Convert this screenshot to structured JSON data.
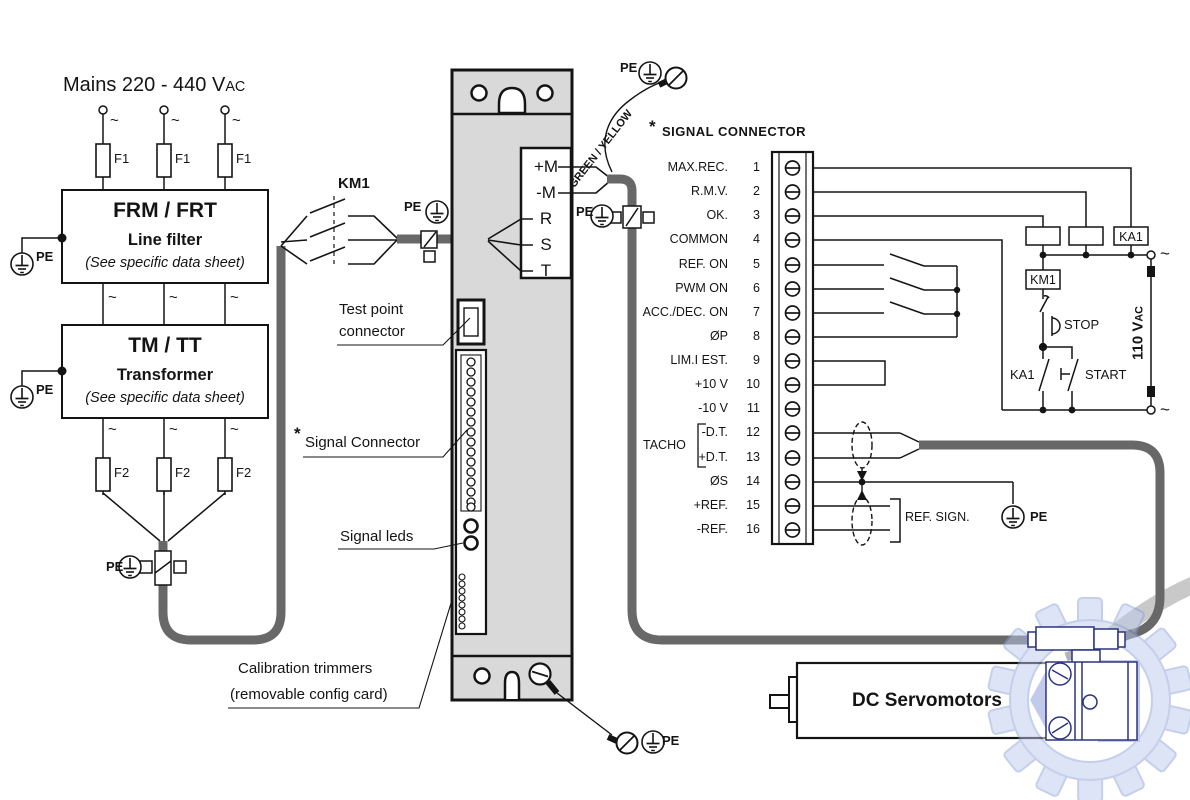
{
  "shared": {
    "pe": "PE",
    "tilde": "~"
  },
  "mains": {
    "title_main": "Mains 220 - 440 V",
    "title_ac": "AC",
    "fuse1": "F1",
    "fuse2": "F2"
  },
  "line_filter": {
    "title": "FRM / FRT",
    "subtitle": "Line filter",
    "note": "(See specific data sheet)"
  },
  "transformer": {
    "title": "TM / TT",
    "subtitle": "Transformer",
    "note": "(See specific data sheet)"
  },
  "contactor_label": "KM1",
  "drive": {
    "terminals": [
      "+M",
      "-M",
      "R",
      "S",
      "T"
    ],
    "test_point_line1": "Test point",
    "test_point_line2": "connector",
    "asterisk": "*",
    "signal_connector_label": "Signal Connector",
    "signal_leds_label": "Signal leds",
    "calibration_line1": "Calibration trimmers",
    "calibration_line2": "(removable config card)"
  },
  "ground_wire_label": "GREEN / YELLOW",
  "signal_connector": {
    "asterisk": "*",
    "title": "SIGNAL  CONNECTOR",
    "tacho_label": "TACHO",
    "ref_sign_label": "REF. SIGN.",
    "rows": [
      {
        "num": "1",
        "label": "MAX.REC."
      },
      {
        "num": "2",
        "label": "R.M.V."
      },
      {
        "num": "3",
        "label": "OK."
      },
      {
        "num": "4",
        "label": "COMMON"
      },
      {
        "num": "5",
        "label": "REF. ON"
      },
      {
        "num": "6",
        "label": "PWM ON"
      },
      {
        "num": "7",
        "label": "ACC./DEC. ON"
      },
      {
        "num": "8",
        "label": "ØP"
      },
      {
        "num": "9",
        "label": "LIM.I EST."
      },
      {
        "num": "10",
        "label": "+10 V"
      },
      {
        "num": "11",
        "label": "-10 V"
      },
      {
        "num": "12",
        "label": "-D.T."
      },
      {
        "num": "13",
        "label": "+D.T."
      },
      {
        "num": "14",
        "label": "ØS"
      },
      {
        "num": "15",
        "label": "+REF."
      },
      {
        "num": "16",
        "label": "-REF."
      }
    ]
  },
  "control": {
    "relay_box": "KA1",
    "km1_box": "KM1",
    "stop": "STOP",
    "start": "START",
    "ka1_contact": "KA1",
    "supply_main": "110 V",
    "supply_ac": "AC"
  },
  "motor_label": "DC Servomotors",
  "colors": {
    "cable_grey": "#686868",
    "drive_fill": "#d9d9d9",
    "watermark_fill": "#bdcaec",
    "watermark_stroke": "#8da0da",
    "navy": "#2b3380"
  }
}
